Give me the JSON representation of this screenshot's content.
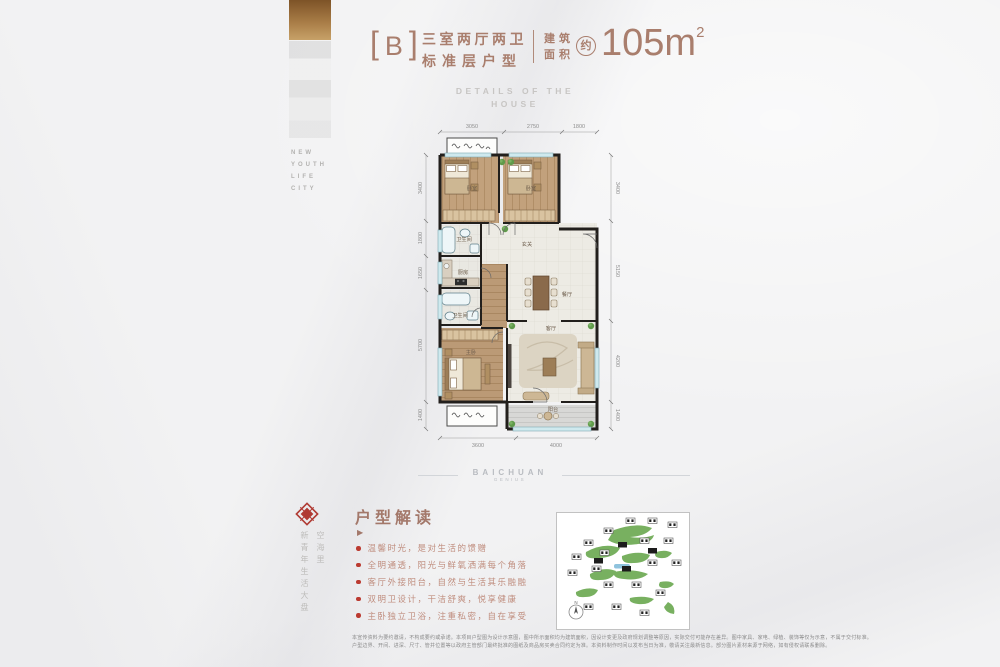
{
  "left_strip": {
    "words": [
      "NEW",
      "YOUTH",
      "LIFE",
      "CITY"
    ]
  },
  "header": {
    "bracket_left": "[",
    "unit": "B",
    "bracket_right": "]",
    "title_line1": "三室两厅两卫",
    "title_line2": "标准层户型",
    "area_label_top": "建筑",
    "area_label_bottom": "面积",
    "approx": "约",
    "area_value": "105m",
    "area_exp": "2"
  },
  "subtitle": {
    "line1": "DETAILS OF THE",
    "line2": "HOUSE"
  },
  "floor_plan": {
    "dims_top": [
      "3050",
      "2750",
      "1800"
    ],
    "dims_bottom": [
      "3600",
      "4000"
    ],
    "dims_left": [
      "3400",
      "1800",
      "1650",
      "5700",
      "1400"
    ],
    "dims_right": [
      "3400",
      "5150",
      "4200",
      "1400"
    ],
    "rooms": {
      "bedroom1": "卧室",
      "bedroom2": "卧室",
      "bath1": "卫生间",
      "kitchen": "厨房",
      "foyer": "玄关",
      "bath2": "卫生间",
      "master": "主卧",
      "dining": "餐厅",
      "living": "客厅",
      "balcony": "阳台"
    }
  },
  "watermark": {
    "brand": "BAICHUAN",
    "sub": "GENIUS"
  },
  "interpretation": {
    "heading": "户型解读",
    "marker": "▶",
    "vertical_right": "空海里",
    "vertical_left": "新青年生活大盘",
    "bullets": [
      "温馨时光，是对生活的馈赠",
      "全明通透，阳光与鲜氧洒满每个角落",
      "客厅外接阳台，自然与生活其乐融融",
      "双明卫设计，干洁舒爽，悦享健康",
      "主卧独立卫浴，注重私密，自在享受"
    ]
  },
  "site_plan": {
    "compass": "N"
  },
  "disclaimer": {
    "line1": "本宣传资料为要约邀请，不构成要约或承诺。本项目户型图为设计示意图，图中所示面积均为建筑面积，因设计变更及政府规划调整等原因，实际交付可能存在差异。图中家具、家电、绿植、装饰等仅为示意，不属于交付标准。",
    "line2": "户型边界、开间、进深、尺寸、管井位置等以政府主管部门最终批准的图纸及商品房买卖合同约定为准。本资料制作时间以发布当日为准，敬请关注最新信息。部分图片素材来源于网络，如有侵权请联系删除。"
  }
}
